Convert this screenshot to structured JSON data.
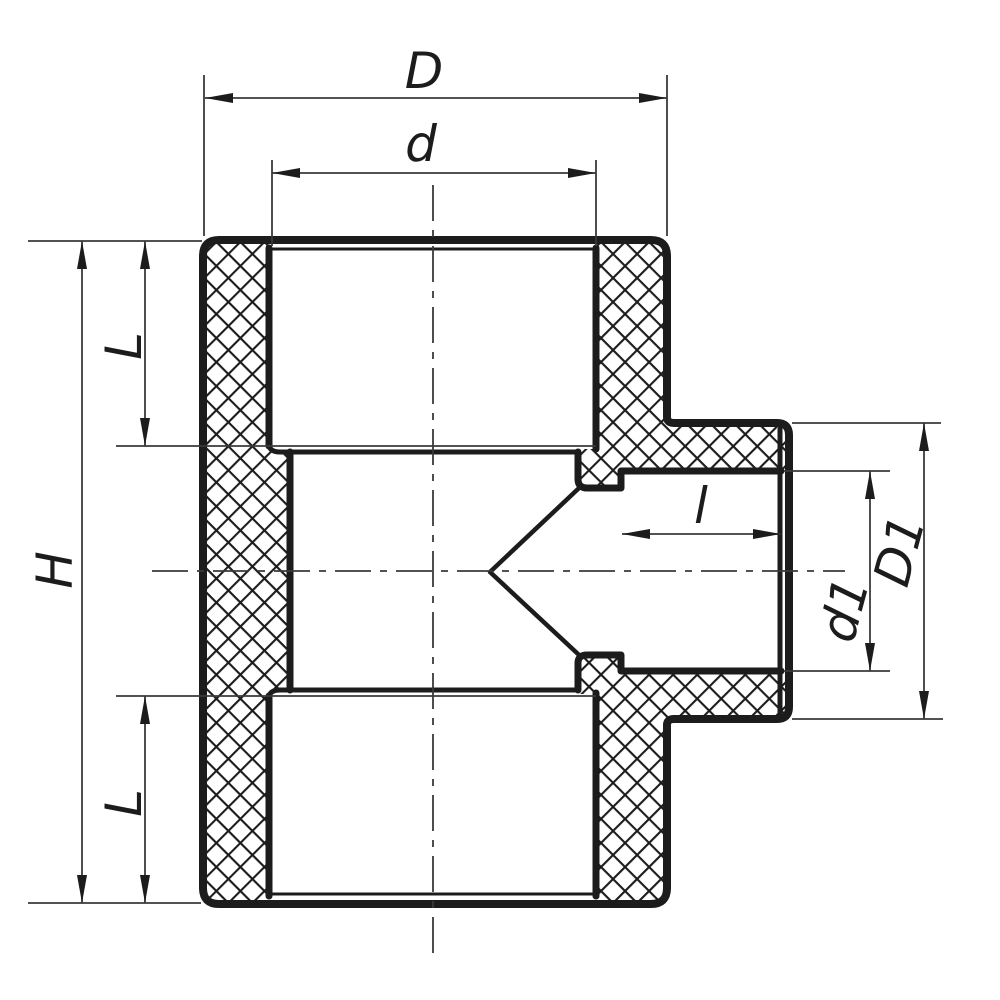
{
  "drawing": {
    "title": "Reducing tee pipe fitting — sectional dimension drawing",
    "type": "technical-section-drawing",
    "colors": {
      "line": "#1c1c1c",
      "thin": "#3a3a3a",
      "background": "#ffffff"
    },
    "dimensions": {
      "overall_width": {
        "label": "D"
      },
      "run_socket_bore": {
        "label": "d"
      },
      "run_socket_depth_top": {
        "label": "L"
      },
      "run_socket_depth_bottom": {
        "label": "L"
      },
      "overall_height": {
        "label": "H"
      },
      "branch_socket_depth": {
        "label": "l"
      },
      "branch_socket_bore": {
        "label": "d1"
      },
      "branch_outer_diameter": {
        "label": "D1"
      }
    }
  }
}
